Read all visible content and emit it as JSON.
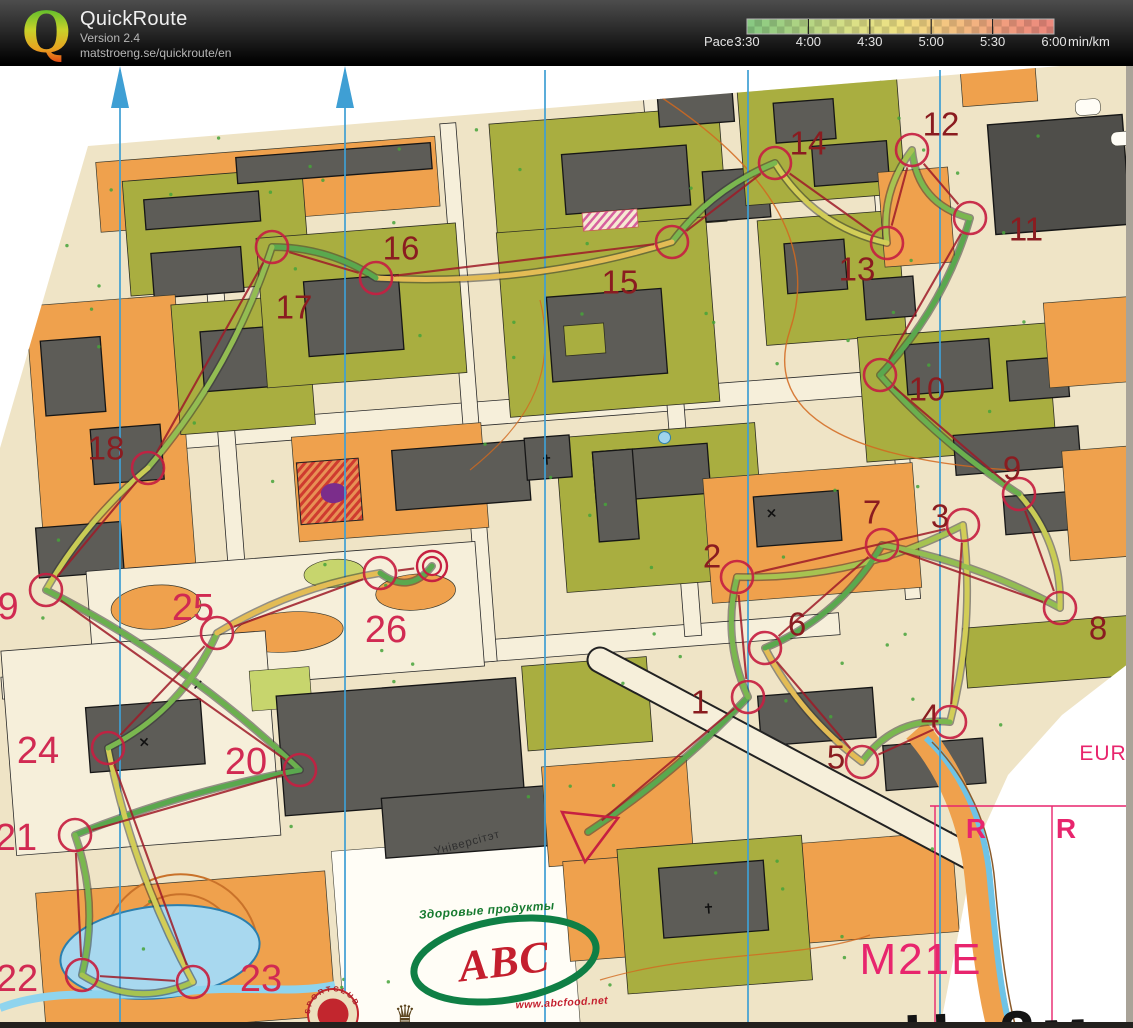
{
  "header": {
    "logo_letter": "Q",
    "app_title": "QuickRoute",
    "version": "Version 2.4",
    "url": "matstroeng.se/quickroute/en",
    "pace_legend": {
      "prefix": "Pace",
      "ticks": [
        "3:30",
        "4:00",
        "4:30",
        "5:00",
        "5:30",
        "6:00"
      ],
      "unit": "min/km",
      "bar_colors": [
        "#7ebd7b",
        "#a3c77c",
        "#cdd37e",
        "#e2d47c",
        "#e6b87a",
        "#e39577",
        "#df7f75"
      ]
    }
  },
  "map": {
    "course_color": "#c62041",
    "line_color": "#9e1b28",
    "meridians": {
      "xs": [
        120,
        345,
        545,
        748,
        940
      ],
      "arrow_xs": [
        120,
        345
      ],
      "color": "#3f9fd4"
    },
    "start": {
      "points": "562,812 618,818 585,862"
    },
    "finish": {
      "x": 432,
      "y": 566
    },
    "controls": [
      {
        "n": 1,
        "label": "1",
        "x": 700,
        "y": 702,
        "cx": 748,
        "cy": 697,
        "tone": "maroon"
      },
      {
        "n": 2,
        "label": "2",
        "x": 712,
        "y": 556,
        "cx": 737,
        "cy": 577,
        "tone": "maroon"
      },
      {
        "n": 3,
        "label": "3",
        "x": 940,
        "y": 516,
        "cx": 963,
        "cy": 525,
        "tone": "maroon"
      },
      {
        "n": 4,
        "label": "4",
        "x": 930,
        "y": 716,
        "cx": 950,
        "cy": 722,
        "tone": "maroon"
      },
      {
        "n": 5,
        "label": "5",
        "x": 836,
        "y": 757,
        "cx": 862,
        "cy": 762,
        "tone": "maroon"
      },
      {
        "n": 6,
        "label": "6",
        "x": 797,
        "y": 624,
        "cx": 765,
        "cy": 648,
        "tone": "maroon"
      },
      {
        "n": 7,
        "label": "7",
        "x": 872,
        "y": 512,
        "cx": 882,
        "cy": 545,
        "tone": "maroon"
      },
      {
        "n": 8,
        "label": "8",
        "x": 1098,
        "y": 628,
        "cx": 1060,
        "cy": 608,
        "tone": "maroon"
      },
      {
        "n": 9,
        "label": "9",
        "x": 1012,
        "y": 468,
        "cx": 1019,
        "cy": 494,
        "tone": "maroon"
      },
      {
        "n": 10,
        "label": "10",
        "x": 927,
        "y": 389,
        "cx": 880,
        "cy": 375,
        "tone": "maroon"
      },
      {
        "n": 11,
        "label": "11",
        "x": 1026,
        "y": 229,
        "cx": 970,
        "cy": 218,
        "tone": "maroon"
      },
      {
        "n": 12,
        "label": "12",
        "x": 941,
        "y": 124,
        "cx": 912,
        "cy": 150,
        "tone": "maroon"
      },
      {
        "n": 13,
        "label": "13",
        "x": 857,
        "y": 269,
        "cx": 887,
        "cy": 243,
        "tone": "maroon"
      },
      {
        "n": 14,
        "label": "14",
        "x": 808,
        "y": 143,
        "cx": 775,
        "cy": 163,
        "tone": "maroon"
      },
      {
        "n": 15,
        "label": "15",
        "x": 620,
        "y": 282,
        "cx": 672,
        "cy": 242,
        "tone": "maroon"
      },
      {
        "n": 16,
        "label": "16",
        "x": 401,
        "y": 248,
        "cx": 376,
        "cy": 278,
        "tone": "maroon"
      },
      {
        "n": 17,
        "label": "17",
        "x": 294,
        "y": 307,
        "cx": 272,
        "cy": 247,
        "tone": "maroon"
      },
      {
        "n": 18,
        "label": "18",
        "x": 106,
        "y": 448,
        "cx": 148,
        "cy": 468,
        "tone": "maroon"
      },
      {
        "n": 19,
        "label": "9",
        "x": 8,
        "y": 607,
        "cx": 46,
        "cy": 590,
        "tone": "crimson"
      },
      {
        "n": 20,
        "label": "20",
        "x": 246,
        "y": 762,
        "cx": 300,
        "cy": 770,
        "tone": "crimson"
      },
      {
        "n": 21,
        "label": "21",
        "x": 16,
        "y": 838,
        "cx": 75,
        "cy": 835,
        "tone": "crimson"
      },
      {
        "n": 22,
        "label": "22",
        "x": 17,
        "y": 979,
        "cx": 82,
        "cy": 975,
        "tone": "crimson"
      },
      {
        "n": 23,
        "label": "23",
        "x": 261,
        "y": 979,
        "cx": 193,
        "cy": 982,
        "tone": "crimson"
      },
      {
        "n": 24,
        "label": "24",
        "x": 38,
        "y": 751,
        "cx": 108,
        "cy": 748,
        "tone": "crimson"
      },
      {
        "n": 25,
        "label": "25",
        "x": 193,
        "y": 608,
        "cx": 217,
        "cy": 633,
        "tone": "crimson"
      },
      {
        "n": 26,
        "label": "26",
        "x": 386,
        "y": 630,
        "cx": 380,
        "cy": 573,
        "tone": "crimson"
      }
    ],
    "tones": {
      "maroon": "#8a1c20",
      "crimson": "#d12a52"
    },
    "route": {
      "points": [
        [
          588,
          832
        ],
        [
          748,
          697
        ],
        [
          737,
          577
        ],
        [
          963,
          525
        ],
        [
          950,
          722
        ],
        [
          862,
          762
        ],
        [
          765,
          648
        ],
        [
          882,
          545
        ],
        [
          1060,
          608
        ],
        [
          1019,
          494
        ],
        [
          880,
          375
        ],
        [
          970,
          218
        ],
        [
          912,
          150
        ],
        [
          887,
          243
        ],
        [
          775,
          163
        ],
        [
          672,
          242
        ],
        [
          376,
          278
        ],
        [
          272,
          247
        ],
        [
          148,
          468
        ],
        [
          46,
          590
        ],
        [
          300,
          770
        ],
        [
          75,
          835
        ],
        [
          82,
          975
        ],
        [
          193,
          982
        ],
        [
          108,
          748
        ],
        [
          217,
          633
        ],
        [
          380,
          573
        ],
        [
          432,
          566
        ]
      ],
      "palette": [
        "#5aa84e",
        "#7ab74f",
        "#a6c351",
        "#d2cd57",
        "#7ab74f",
        "#e3bc55",
        "#5aa84e",
        "#93bd52",
        "#c9cc55",
        "#6bb04e"
      ]
    },
    "labels": [
      {
        "id": "universitet",
        "text": "Універсітэт",
        "x": 468,
        "y": 846,
        "size": 11.5,
        "color": "#2f2f2f",
        "rotate": -15,
        "weight": "400",
        "style": "normal",
        "family": "Liberation Sans",
        "spacing": 0.8,
        "anchor": "middle"
      },
      {
        "id": "abc-tagline",
        "text": "Здоровые продукты",
        "x": 487,
        "y": 914,
        "size": 12,
        "color": "#167a2f",
        "rotate": -4,
        "weight": "700",
        "style": "italic",
        "family": "Liberation Sans",
        "spacing": 0.5,
        "anchor": "middle"
      },
      {
        "id": "abc-logo-text",
        "text": "ABC",
        "x": 506,
        "y": 976,
        "size": 44,
        "color": "#c41f2e",
        "rotate": -7,
        "weight": "700",
        "style": "italic",
        "family": "Liberation Serif",
        "spacing": 1,
        "anchor": "middle"
      },
      {
        "id": "abc-url",
        "text": "www.abcfood.net",
        "x": 562,
        "y": 1006,
        "size": 10.5,
        "color": "#c41f2e",
        "rotate": -3,
        "weight": "700",
        "style": "italic",
        "family": "Liberation Sans",
        "spacing": 0.4,
        "anchor": "middle"
      },
      {
        "id": "class-m21e",
        "text": "M21E",
        "x": 921,
        "y": 974,
        "size": 44,
        "color": "#e8256d",
        "rotate": 0,
        "weight": "400",
        "style": "normal",
        "family": "Liberation Sans",
        "spacing": 2,
        "anchor": "middle"
      },
      {
        "id": "height-note",
        "text": "Н=2м",
        "x": 1000,
        "y": 1056,
        "size": 64,
        "color": "#141414",
        "rotate": -2,
        "weight": "700",
        "style": "normal",
        "family": "Liberation Sans",
        "spacing": 6,
        "anchor": "middle"
      },
      {
        "id": "eur-label",
        "text": "EUR",
        "x": 1103,
        "y": 760,
        "size": 21,
        "color": "#e8256d",
        "rotate": 0,
        "weight": "400",
        "style": "normal",
        "family": "Liberation Sans",
        "spacing": 1,
        "anchor": "middle"
      },
      {
        "id": "r-label-1",
        "text": "R",
        "x": 976,
        "y": 838,
        "size": 28,
        "color": "#e8256d",
        "rotate": 0,
        "weight": "700",
        "style": "normal",
        "family": "Liberation Sans",
        "spacing": 0,
        "anchor": "middle"
      },
      {
        "id": "r-label-2",
        "text": "R",
        "x": 1066,
        "y": 838,
        "size": 28,
        "color": "#e8256d",
        "rotate": 0,
        "weight": "700",
        "style": "normal",
        "family": "Liberation Sans",
        "spacing": 0,
        "anchor": "middle"
      },
      {
        "id": "sportclub-text",
        "text": "SPORTCLUB",
        "x": 333,
        "y": 1014,
        "size": 7.5,
        "color": "#ab1f27",
        "rotate": 0,
        "weight": "700",
        "style": "normal",
        "family": "Liberation Sans",
        "spacing": 2,
        "anchor": "middle"
      },
      {
        "id": "crown-glyph",
        "text": "♛",
        "x": 405,
        "y": 1022,
        "size": 24,
        "color": "#5a431c",
        "rotate": 0,
        "weight": "400",
        "style": "normal",
        "family": "DejaVu Sans",
        "spacing": 0,
        "anchor": "middle"
      }
    ]
  }
}
